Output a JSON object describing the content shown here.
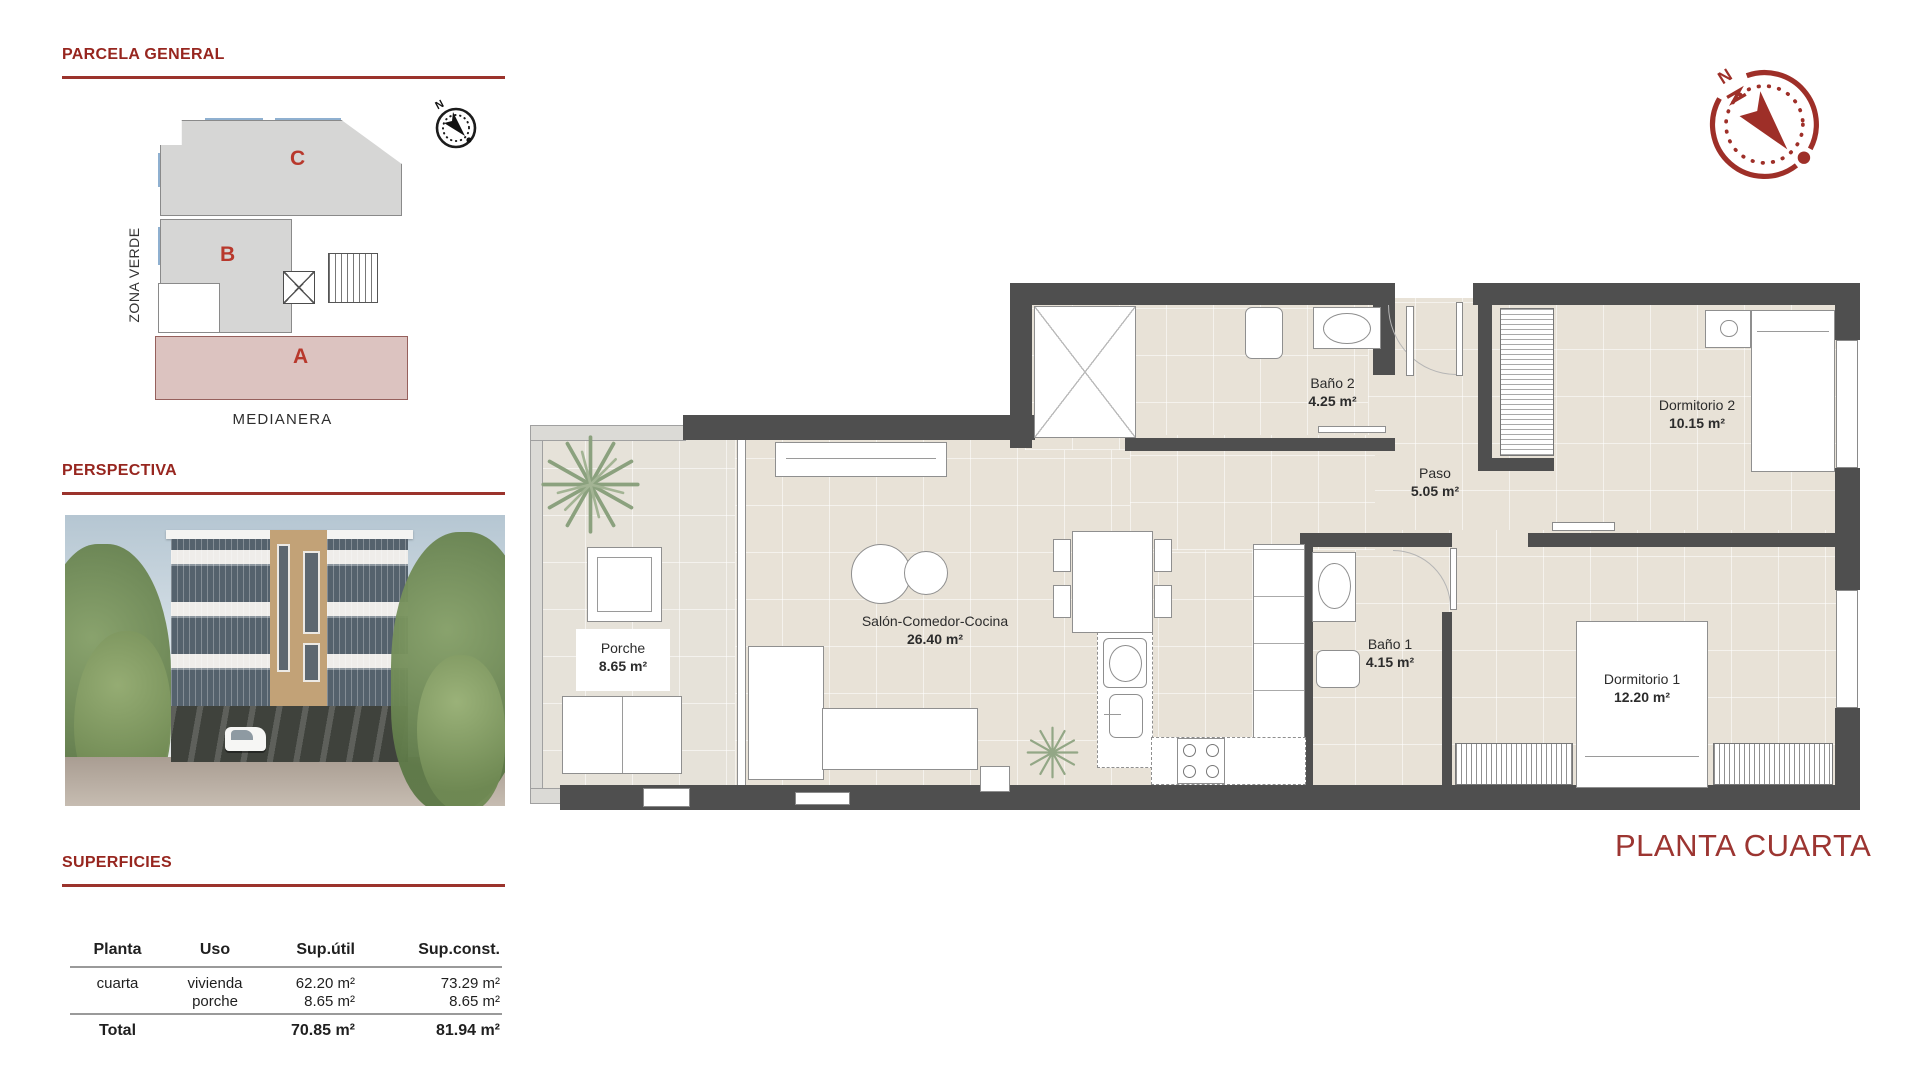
{
  "parcela": {
    "title": "PARCELA GENERAL",
    "blocks": {
      "a": "A",
      "b": "B",
      "c": "C"
    },
    "zona_verde": "ZONA VERDE",
    "medianera": "MEDIANERA",
    "compass_n": "N"
  },
  "perspectiva": {
    "title": "PERSPECTIVA"
  },
  "superficies": {
    "title": "SUPERFICIES",
    "headers": {
      "planta": "Planta",
      "uso": "Uso",
      "sup_util": "Sup.útil",
      "sup_const": "Sup.const."
    },
    "row": {
      "planta": "cuarta",
      "uso1": "vivienda",
      "uso2": "porche",
      "util1": "62.20 m²",
      "util2": "8.65 m²",
      "const1": "73.29 m²",
      "const2": "8.65 m²"
    },
    "total": {
      "label": "Total",
      "util": "70.85 m²",
      "const": "81.94 m²"
    }
  },
  "floorplan": {
    "title": "PLANTA CUARTA",
    "compass_n": "N",
    "rooms": [
      {
        "name": "Porche",
        "area": "8.65 m²"
      },
      {
        "name": "Salón-Comedor-Cocina",
        "area": "26.40 m²"
      },
      {
        "name": "Baño 2",
        "area": "4.25 m²"
      },
      {
        "name": "Paso",
        "area": "5.05 m²"
      },
      {
        "name": "Dormitorio 2",
        "area": "10.15 m²"
      },
      {
        "name": "Baño 1",
        "area": "4.15 m²"
      },
      {
        "name": "Dormitorio 1",
        "area": "12.20 m²"
      }
    ]
  },
  "colors": {
    "accent": "#97261f",
    "wall": "#4f4f4f",
    "floor": "#e8e2d7",
    "rose": "#dcc3c0"
  }
}
